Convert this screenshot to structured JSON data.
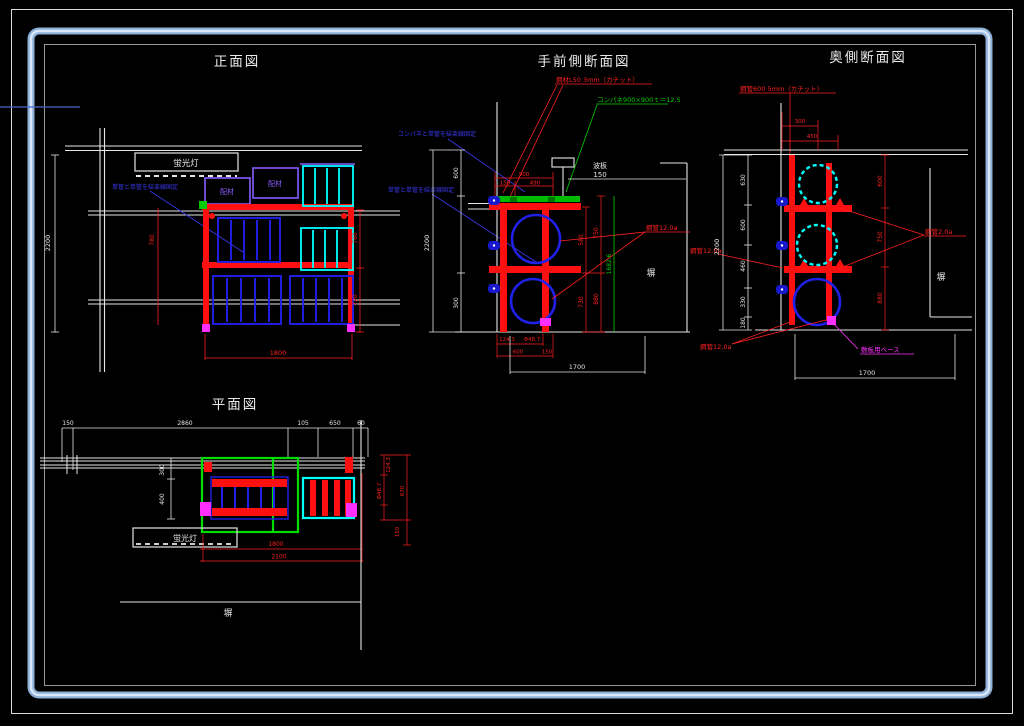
{
  "canvas": {
    "background": "#000000",
    "border_outer_color": "#e8e8e8",
    "border_band_color": "#a9c3e4",
    "accent_colors": {
      "red": "#ff0000",
      "blue": "#0000ff",
      "cyan": "#00ffff",
      "green": "#00cc00",
      "magenta": "#ff00ff",
      "purple": "#7744ee",
      "white": "#ffffff"
    }
  },
  "views": {
    "front": {
      "title": "正面図",
      "fluorescent_label": "蛍光灯",
      "tie_note": "単管と単管を結束線固定",
      "box_label_left": "配材",
      "box_label_right": "配材",
      "dims": {
        "total_height": "2200",
        "inner_height": "780",
        "right_upper": "760",
        "right_lower": "720",
        "bottom_width": "1800"
      }
    },
    "near_section": {
      "title": "手前側断面図",
      "steel_note": "鋼材L50 3mm（カチット）",
      "panel_note": "コンパネ900×900ｔ＝12.5",
      "tie_note_upper": "コンパネと単管を結束線固定",
      "tie_note_lower": "単管と単管を結束線固定",
      "pipe_note": "鋼管12.0a",
      "wall_label": "塀",
      "top_dim_label": "波板",
      "top_dim_value": "150",
      "dims": {
        "top_width": "900",
        "top_left": "150",
        "top_right": "490",
        "left_total": "2200",
        "left_upper": "600",
        "left_lower": "300",
        "right_inner_upper": "580",
        "right_inner_lower": "730",
        "right_outer_upper": "750",
        "right_outer_lower": "880",
        "green_height": "1682.6",
        "base_offset": "124.3",
        "pipe_dia": "Φ48.7",
        "base_width": "600",
        "base_gap": "150",
        "bottom_width": "1700"
      }
    },
    "far_section": {
      "title": "奥側断面図",
      "steel_note": "鋼管600 5mm（カチット）",
      "pipe_note_left": "鋼管12.0a",
      "pipe_note_right": "鋼管2.0a",
      "pipe_note_bottom": "鋼管12.0a",
      "base_note": "敷板用ベース",
      "wall_label": "塀",
      "dims": {
        "top_first": "300",
        "top_second": "450",
        "left_total": "2200",
        "left_1": "630",
        "left_2": "600",
        "left_3": "460",
        "left_4": "330",
        "left_5": "180",
        "right_1": "600",
        "right_2": "750",
        "right_3": "880",
        "bottom_width": "1700"
      }
    },
    "plan": {
      "title": "平面図",
      "fluorescent_label": "蛍光灯",
      "wall_label": "塀",
      "dims": {
        "top_1": "150",
        "top_2": "2860",
        "top_3": "105",
        "top_4": "650",
        "top_5": "60",
        "left_1": "300",
        "left_2": "400",
        "right_1": "124.3",
        "right_2": "Φ48.7",
        "right_3": "670",
        "right_4": "150",
        "bottom_1": "1800",
        "bottom_2": "2100"
      }
    }
  }
}
